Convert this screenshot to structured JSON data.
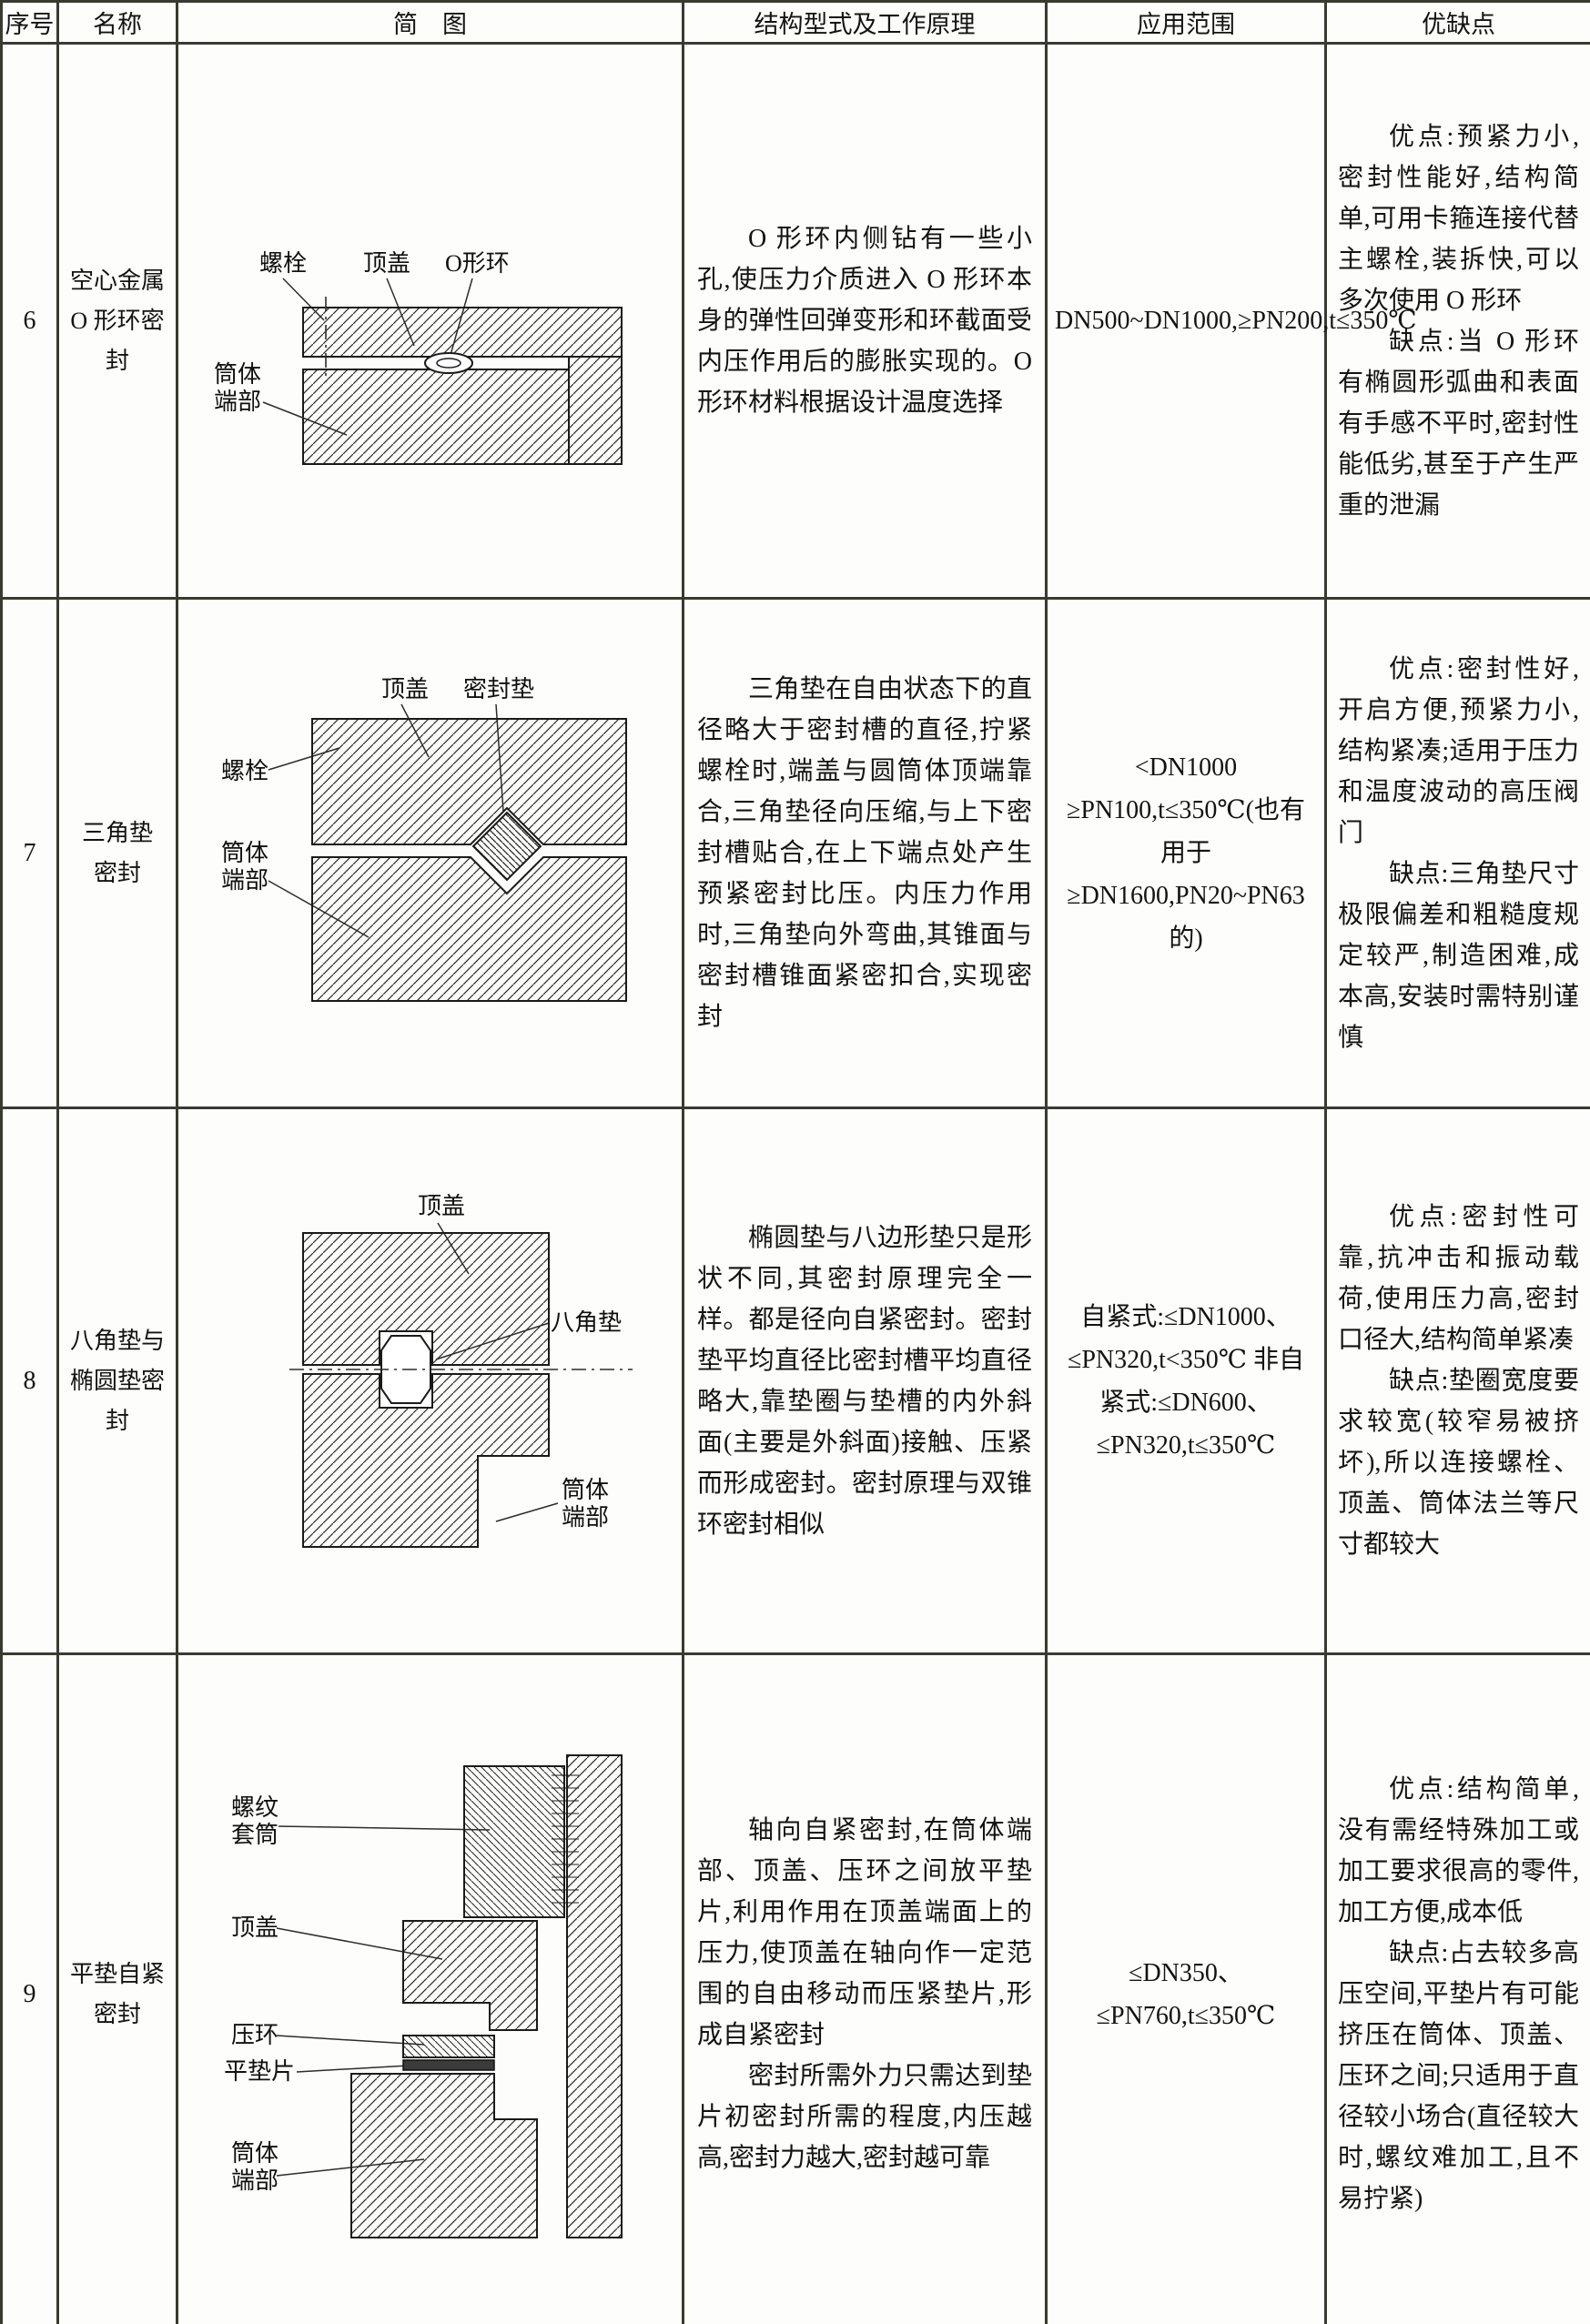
{
  "table": {
    "headers": [
      "序号",
      "名称",
      "简　图",
      "结构型式及工作原理",
      "应用范围",
      "优缺点"
    ],
    "rows": [
      {
        "no": "6",
        "name": "空心金属\nO 形环密封",
        "diagram": {
          "bolt": "螺栓",
          "cover": "顶盖",
          "oring": "O形环",
          "tube1": "筒体",
          "tube2": "端部"
        },
        "principle": [
          "O 形环内侧钻有一些小孔,使压力介质进入 O 形环本身的弹性回弹变形和环截面受内压作用后的膨胀实现的。O 形环材料根据设计温度选择"
        ],
        "application": "DN500~DN1000,≥PN200,t≤350℃",
        "pros": "优点:预紧力小,密封性能好,结构简单,可用卡箍连接代替主螺栓,装拆快,可以多次使用 O 形环",
        "cons": "缺点:当 O 形环有椭圆形弧曲和表面有手感不平时,密封性能低劣,甚至于产生严重的泄漏"
      },
      {
        "no": "7",
        "name": "三角垫\n密封",
        "diagram": {
          "cover": "顶盖",
          "gasket": "密封垫",
          "bolt": "螺栓",
          "tube1": "筒体",
          "tube2": "端部"
        },
        "principle": [
          "三角垫在自由状态下的直径略大于密封槽的直径,拧紧螺栓时,端盖与圆筒体顶端靠合,三角垫径向压缩,与上下密封槽贴合,在上下端点处产生预紧密封比压。内压力作用时,三角垫向外弯曲,其锥面与密封槽锥面紧密扣合,实现密封"
        ],
        "application": "<DN1000 ≥PN100,t≤350℃(也有用于≥DN1600,PN20~PN63 的)",
        "pros": "优点:密封性好,开启方便,预紧力小,结构紧凑;适用于压力和温度波动的高压阀门",
        "cons": "缺点:三角垫尺寸极限偏差和粗糙度规定较严,制造困难,成本高,安装时需特别谨慎"
      },
      {
        "no": "8",
        "name": "八角垫与\n椭圆垫密封",
        "diagram": {
          "cover": "顶盖",
          "gasket": "八角垫",
          "tube1": "筒体",
          "tube2": "端部"
        },
        "principle": [
          "椭圆垫与八边形垫只是形状不同,其密封原理完全一样。都是径向自紧密封。密封垫平均直径比密封槽平均直径略大,靠垫圈与垫槽的内外斜面(主要是外斜面)接触、压紧而形成密封。密封原理与双锥环密封相似"
        ],
        "application": "自紧式:≤DN1000、≤PN320,t<350℃ 非自紧式:≤DN600、≤PN320,t≤350℃",
        "pros": "优点:密封性可靠,抗冲击和振动载荷,使用压力高,密封口径大,结构简单紧凑",
        "cons": "缺点:垫圈宽度要求较宽(较窄易被挤坏),所以连接螺栓、顶盖、筒体法兰等尺寸都较大"
      },
      {
        "no": "9",
        "name": "平垫自紧\n密封",
        "diagram": {
          "sleeve1": "螺纹",
          "sleeve2": "套筒",
          "cover": "顶盖",
          "ring": "压环",
          "gasket": "平垫片",
          "tube1": "筒体",
          "tube2": "端部"
        },
        "principle": [
          "轴向自紧密封,在筒体端部、顶盖、压环之间放平垫片,利用作用在顶盖端面上的压力,使顶盖在轴向作一定范围的自由移动而压紧垫片,形成自紧密封",
          "密封所需外力只需达到垫片初密封所需的程度,内压越高,密封力越大,密封越可靠"
        ],
        "application": "≤DN350、≤PN760,t≤350℃",
        "pros": "优点:结构简单,没有需经特殊加工或加工要求很高的零件,加工方便,成本低",
        "cons": "缺点:占去较多高压空间,平垫片有可能挤压在筒体、顶盖、压环之间;只适用于直径较小场合(直径较大时,螺纹难加工,且不易拧紧)"
      }
    ]
  }
}
